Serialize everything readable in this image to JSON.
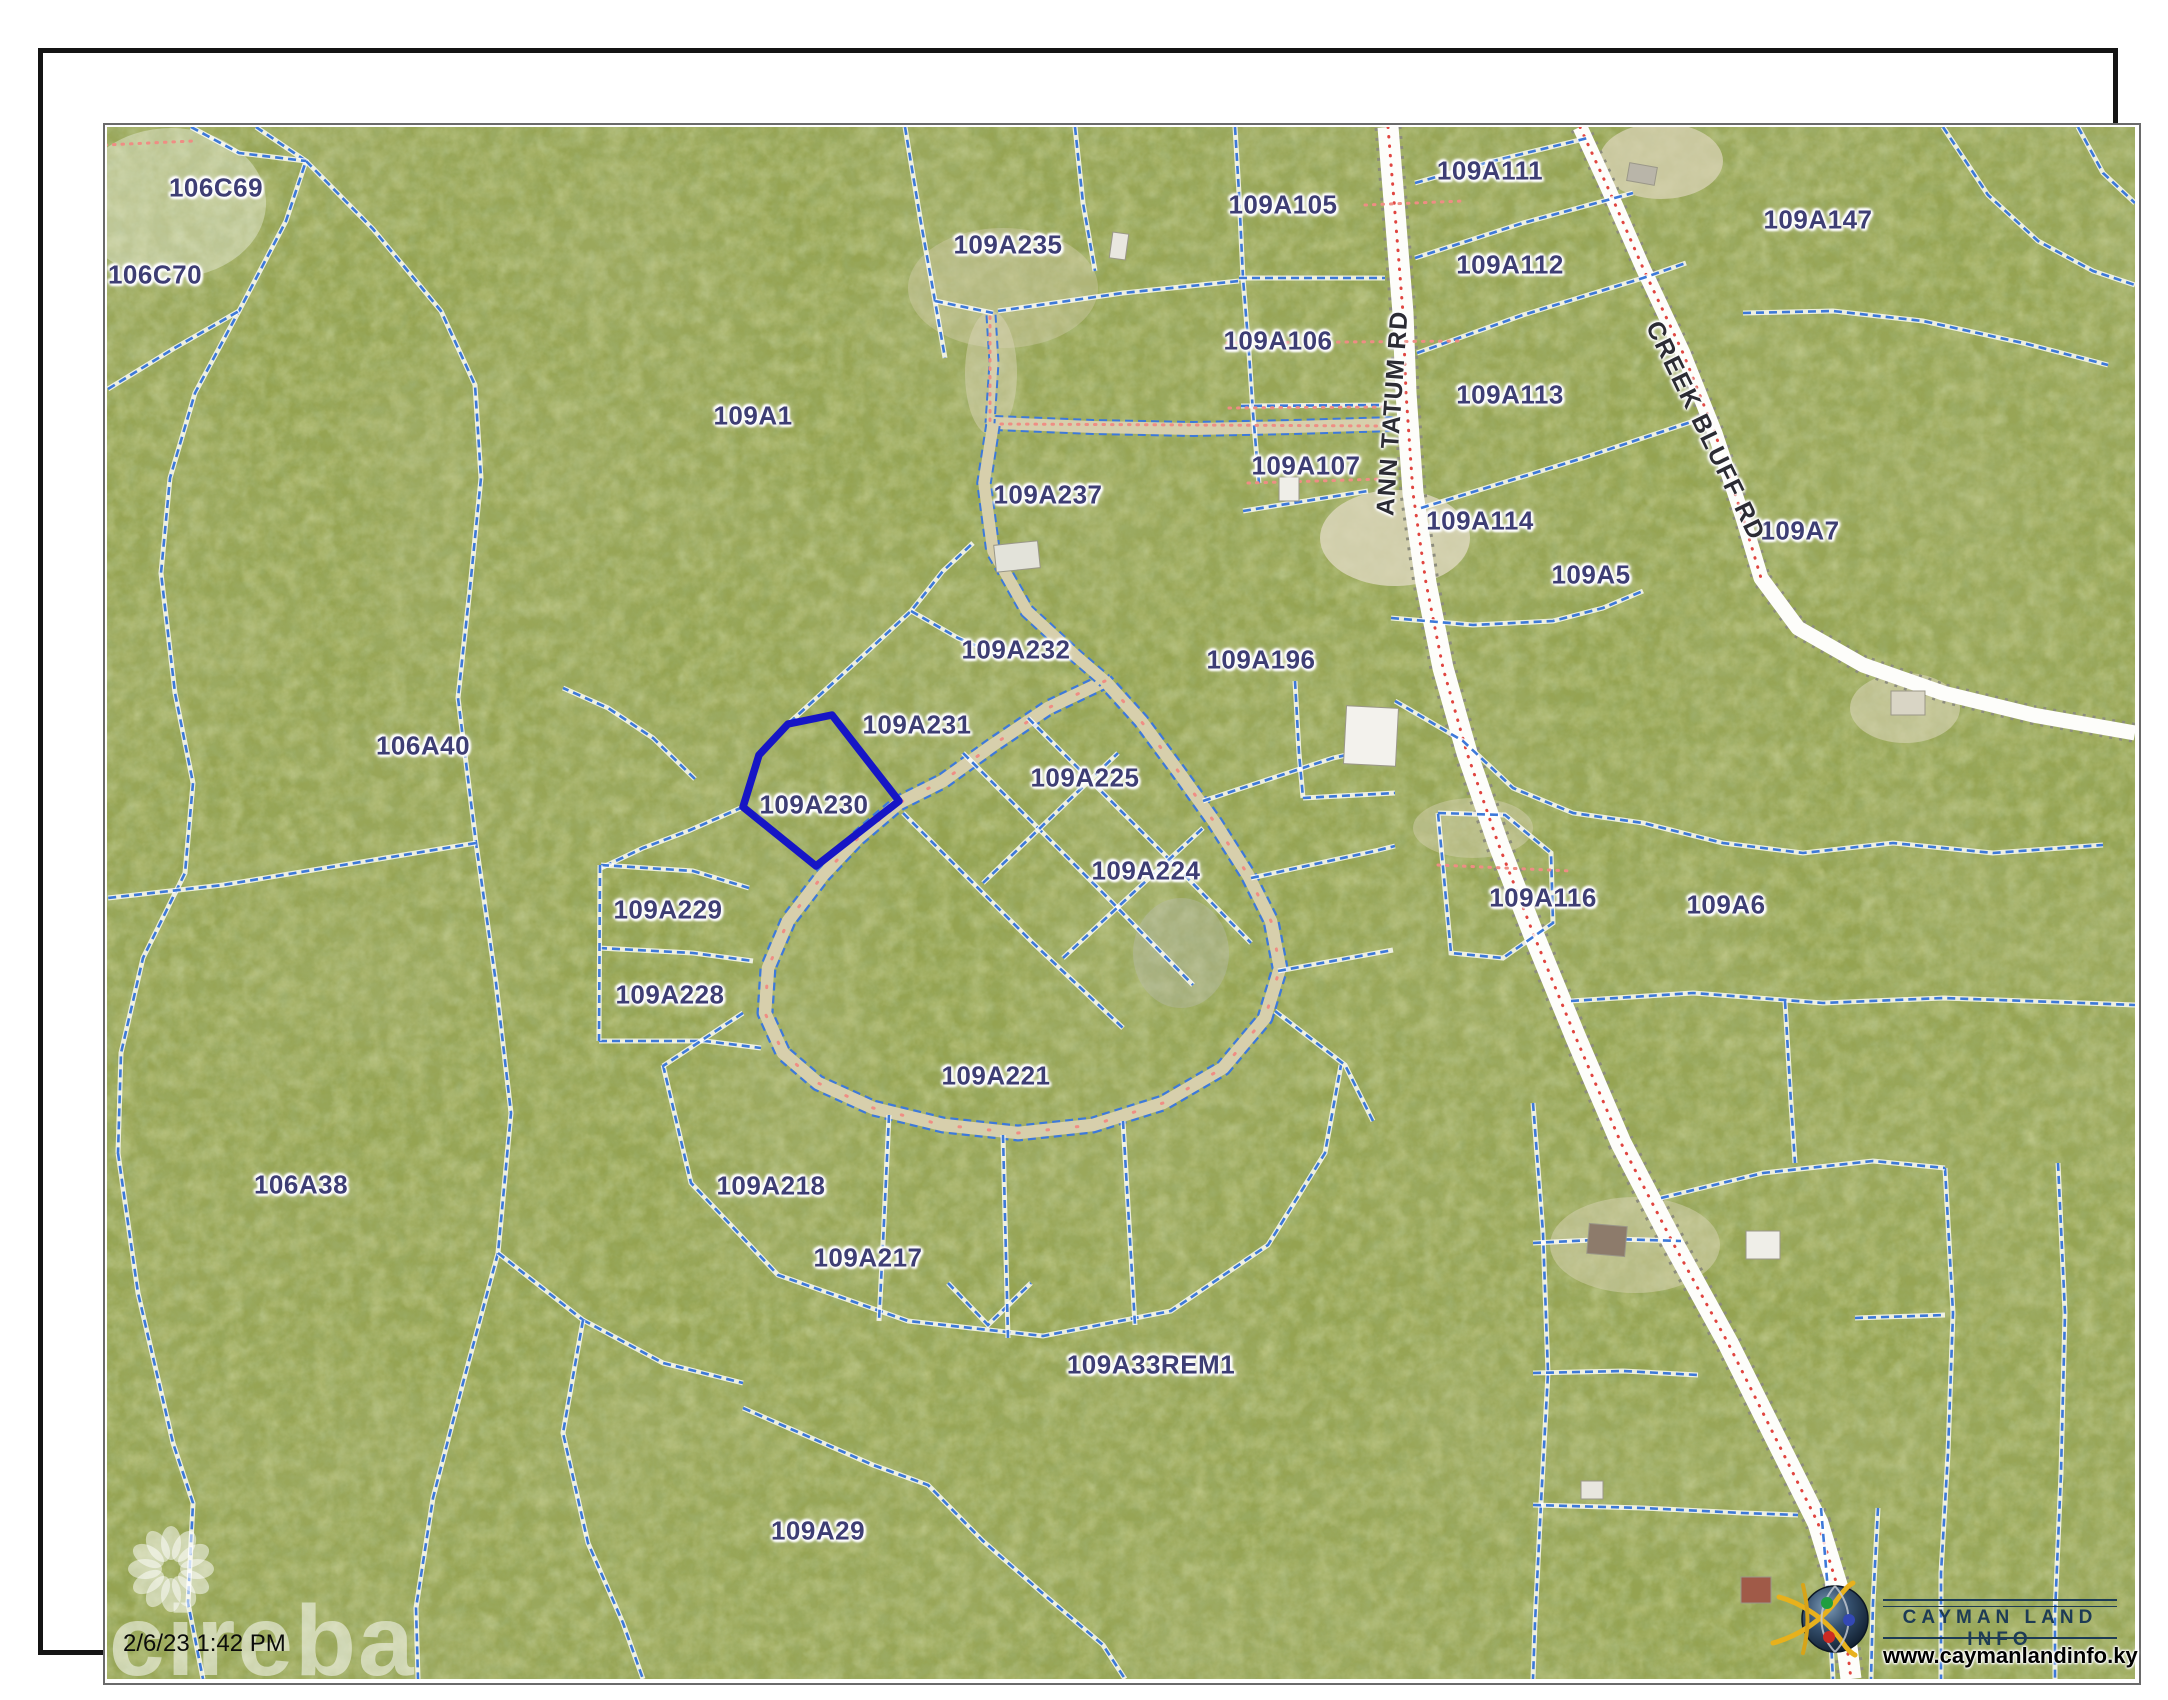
{
  "map": {
    "base_color": "#95a351",
    "parcel_line_color": "#3d79d9",
    "highlight_color": "#1615c5",
    "road_fill": "#fdfdfa",
    "dirt_road_fill": "#d7cfac",
    "centerline_color": "#e04540",
    "pink_dot_color": "#ef8d84",
    "label_color": "#3e3e74"
  },
  "selected_parcel": {
    "id": "109A230",
    "points": "745,671 789,662 856,748 773,813 700,754 716,702",
    "label_x": 771,
    "label_y": 752
  },
  "parcel_labels": [
    {
      "text": "106C69",
      "x": 173,
      "y": 135
    },
    {
      "text": "106C70",
      "x": 112,
      "y": 222
    },
    {
      "text": "109A1",
      "x": 710,
      "y": 363
    },
    {
      "text": "109A235",
      "x": 965,
      "y": 192
    },
    {
      "text": "109A105",
      "x": 1240,
      "y": 152
    },
    {
      "text": "109A106",
      "x": 1235,
      "y": 288
    },
    {
      "text": "109A107",
      "x": 1263,
      "y": 413
    },
    {
      "text": "109A237",
      "x": 1005,
      "y": 442
    },
    {
      "text": "109A111",
      "x": 1447,
      "y": 118
    },
    {
      "text": "109A112",
      "x": 1467,
      "y": 212
    },
    {
      "text": "109A113",
      "x": 1467,
      "y": 342
    },
    {
      "text": "109A147",
      "x": 1775,
      "y": 167
    },
    {
      "text": "109A7",
      "x": 1757,
      "y": 478
    },
    {
      "text": "109A114",
      "x": 1437,
      "y": 468
    },
    {
      "text": "109A5",
      "x": 1548,
      "y": 522
    },
    {
      "text": "109A196",
      "x": 1218,
      "y": 607
    },
    {
      "text": "109A232",
      "x": 973,
      "y": 597
    },
    {
      "text": "109A231",
      "x": 874,
      "y": 672
    },
    {
      "text": "109A225",
      "x": 1042,
      "y": 725
    },
    {
      "text": "109A224",
      "x": 1103,
      "y": 818
    },
    {
      "text": "106A40",
      "x": 380,
      "y": 693
    },
    {
      "text": "109A229",
      "x": 625,
      "y": 857
    },
    {
      "text": "109A228",
      "x": 627,
      "y": 942
    },
    {
      "text": "109A116",
      "x": 1500,
      "y": 845
    },
    {
      "text": "109A6",
      "x": 1683,
      "y": 852
    },
    {
      "text": "109A221",
      "x": 953,
      "y": 1023
    },
    {
      "text": "109A218",
      "x": 728,
      "y": 1133
    },
    {
      "text": "109A217",
      "x": 825,
      "y": 1205
    },
    {
      "text": "106A38",
      "x": 258,
      "y": 1132
    },
    {
      "text": "109A33REM1",
      "x": 1108,
      "y": 1312
    },
    {
      "text": "109A29",
      "x": 775,
      "y": 1478
    }
  ],
  "road_labels": [
    {
      "text": "ANN TATUM RD",
      "x": 1350,
      "y": 360,
      "rot": -86
    },
    {
      "text": "CREEK BLUFF RD",
      "x": 1662,
      "y": 378,
      "rot": 64
    }
  ],
  "overlay": {
    "timestamp": "2/6/23 1:42 PM",
    "brand_watermark": "cireba"
  },
  "logo": {
    "title": "CAYMAN LAND INFO",
    "url": "www.caymanlandinfo.ky"
  }
}
